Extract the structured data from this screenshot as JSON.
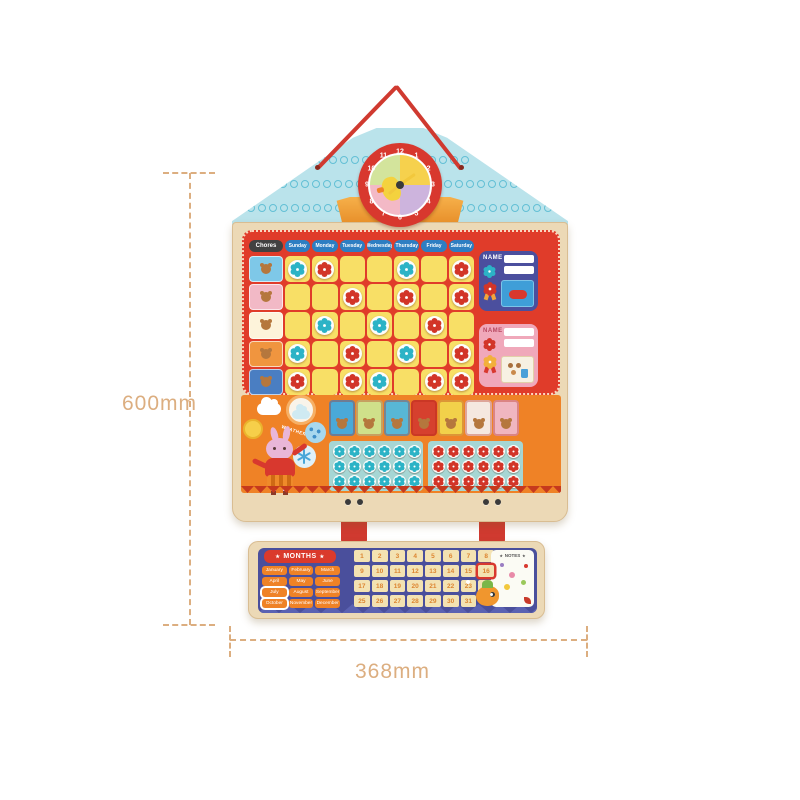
{
  "annotations": {
    "height_label": "600mm",
    "width_label": "368mm"
  },
  "clock": {
    "numbers": [
      "12",
      "1",
      "2",
      "3",
      "4",
      "5",
      "6",
      "7",
      "8",
      "9",
      "10",
      "11"
    ]
  },
  "chart": {
    "chores_label": "Chores",
    "days": [
      "Sunday",
      "Monday",
      "Tuesday",
      "Wednesday",
      "Thursday",
      "Friday",
      "Saturday"
    ],
    "chores": [
      {
        "name": "wake-up-bear",
        "color": "#7ec8e8"
      },
      {
        "name": "snack-drink",
        "color": "#f2b9c6"
      },
      {
        "name": "play-time",
        "color": "#fdf3da"
      },
      {
        "name": "homework",
        "color": "#f0953f"
      },
      {
        "name": "bed-time",
        "color": "#4a7ec2"
      }
    ],
    "star_grid": [
      [
        "blue",
        "red",
        "",
        "",
        "blue",
        "",
        "red"
      ],
      [
        "",
        "",
        "red",
        "",
        "red",
        "",
        "red"
      ],
      [
        "",
        "blue",
        "",
        "blue",
        "",
        "red",
        ""
      ],
      [
        "blue",
        "",
        "red",
        "",
        "blue",
        "",
        "red"
      ],
      [
        "red",
        "",
        "red",
        "blue",
        "",
        "red",
        "red"
      ]
    ],
    "name_panels": [
      {
        "label": "NAME",
        "theme": "blue",
        "reward_card": "game-controller"
      },
      {
        "label": "NAME",
        "theme": "pink",
        "reward_card": "snacks"
      }
    ]
  },
  "weather": {
    "label": "WEATHER",
    "options": [
      "cloudy",
      "partly-cloudy",
      "sunny",
      "rainy",
      "snowy"
    ]
  },
  "activities": [
    {
      "name": "toilet",
      "color": "#4aa9d8"
    },
    {
      "name": "reading",
      "color": "#cfe08a"
    },
    {
      "name": "brush-teeth",
      "color": "#58b7d6"
    },
    {
      "name": "football",
      "color": "#d6402e"
    },
    {
      "name": "sleep",
      "color": "#f2d14a"
    },
    {
      "name": "bath",
      "color": "#f5e8e0"
    },
    {
      "name": "wash-hands",
      "color": "#f0b6c0"
    }
  ],
  "tokens": {
    "blue_count": 18,
    "red_count": 18
  },
  "calendar": {
    "title": "MONTHS",
    "star_icon": "★",
    "months": [
      "January",
      "February",
      "March",
      "April",
      "May",
      "June",
      "July",
      "August",
      "September",
      "October",
      "November",
      "December"
    ],
    "highlighted_months": [
      "July",
      "October"
    ],
    "dates": [
      1,
      2,
      3,
      4,
      5,
      6,
      7,
      8,
      9,
      10,
      11,
      12,
      13,
      14,
      15,
      16,
      17,
      18,
      19,
      20,
      21,
      22,
      23,
      24,
      25,
      26,
      27,
      28,
      29,
      30,
      31
    ],
    "highlighted_date": 16,
    "notes_label": "NOTES"
  },
  "colors": {
    "wood": "#ecd9b6",
    "red_panel": "#e03c2a",
    "day_blue": "#2d7ec2",
    "cell_yellow": "#f8df66",
    "flower_blue": "#2cb3c6",
    "flower_red": "#d23528",
    "orange": "#ef8226",
    "navy": "#4b4f9e",
    "pink": "#f0a8ba",
    "cal_navy": "#4a4f9c",
    "month_orange": "#ef8226",
    "roof_blue": "#bae3eb",
    "cord_red": "#d03a30",
    "dim": "#dcae80"
  }
}
